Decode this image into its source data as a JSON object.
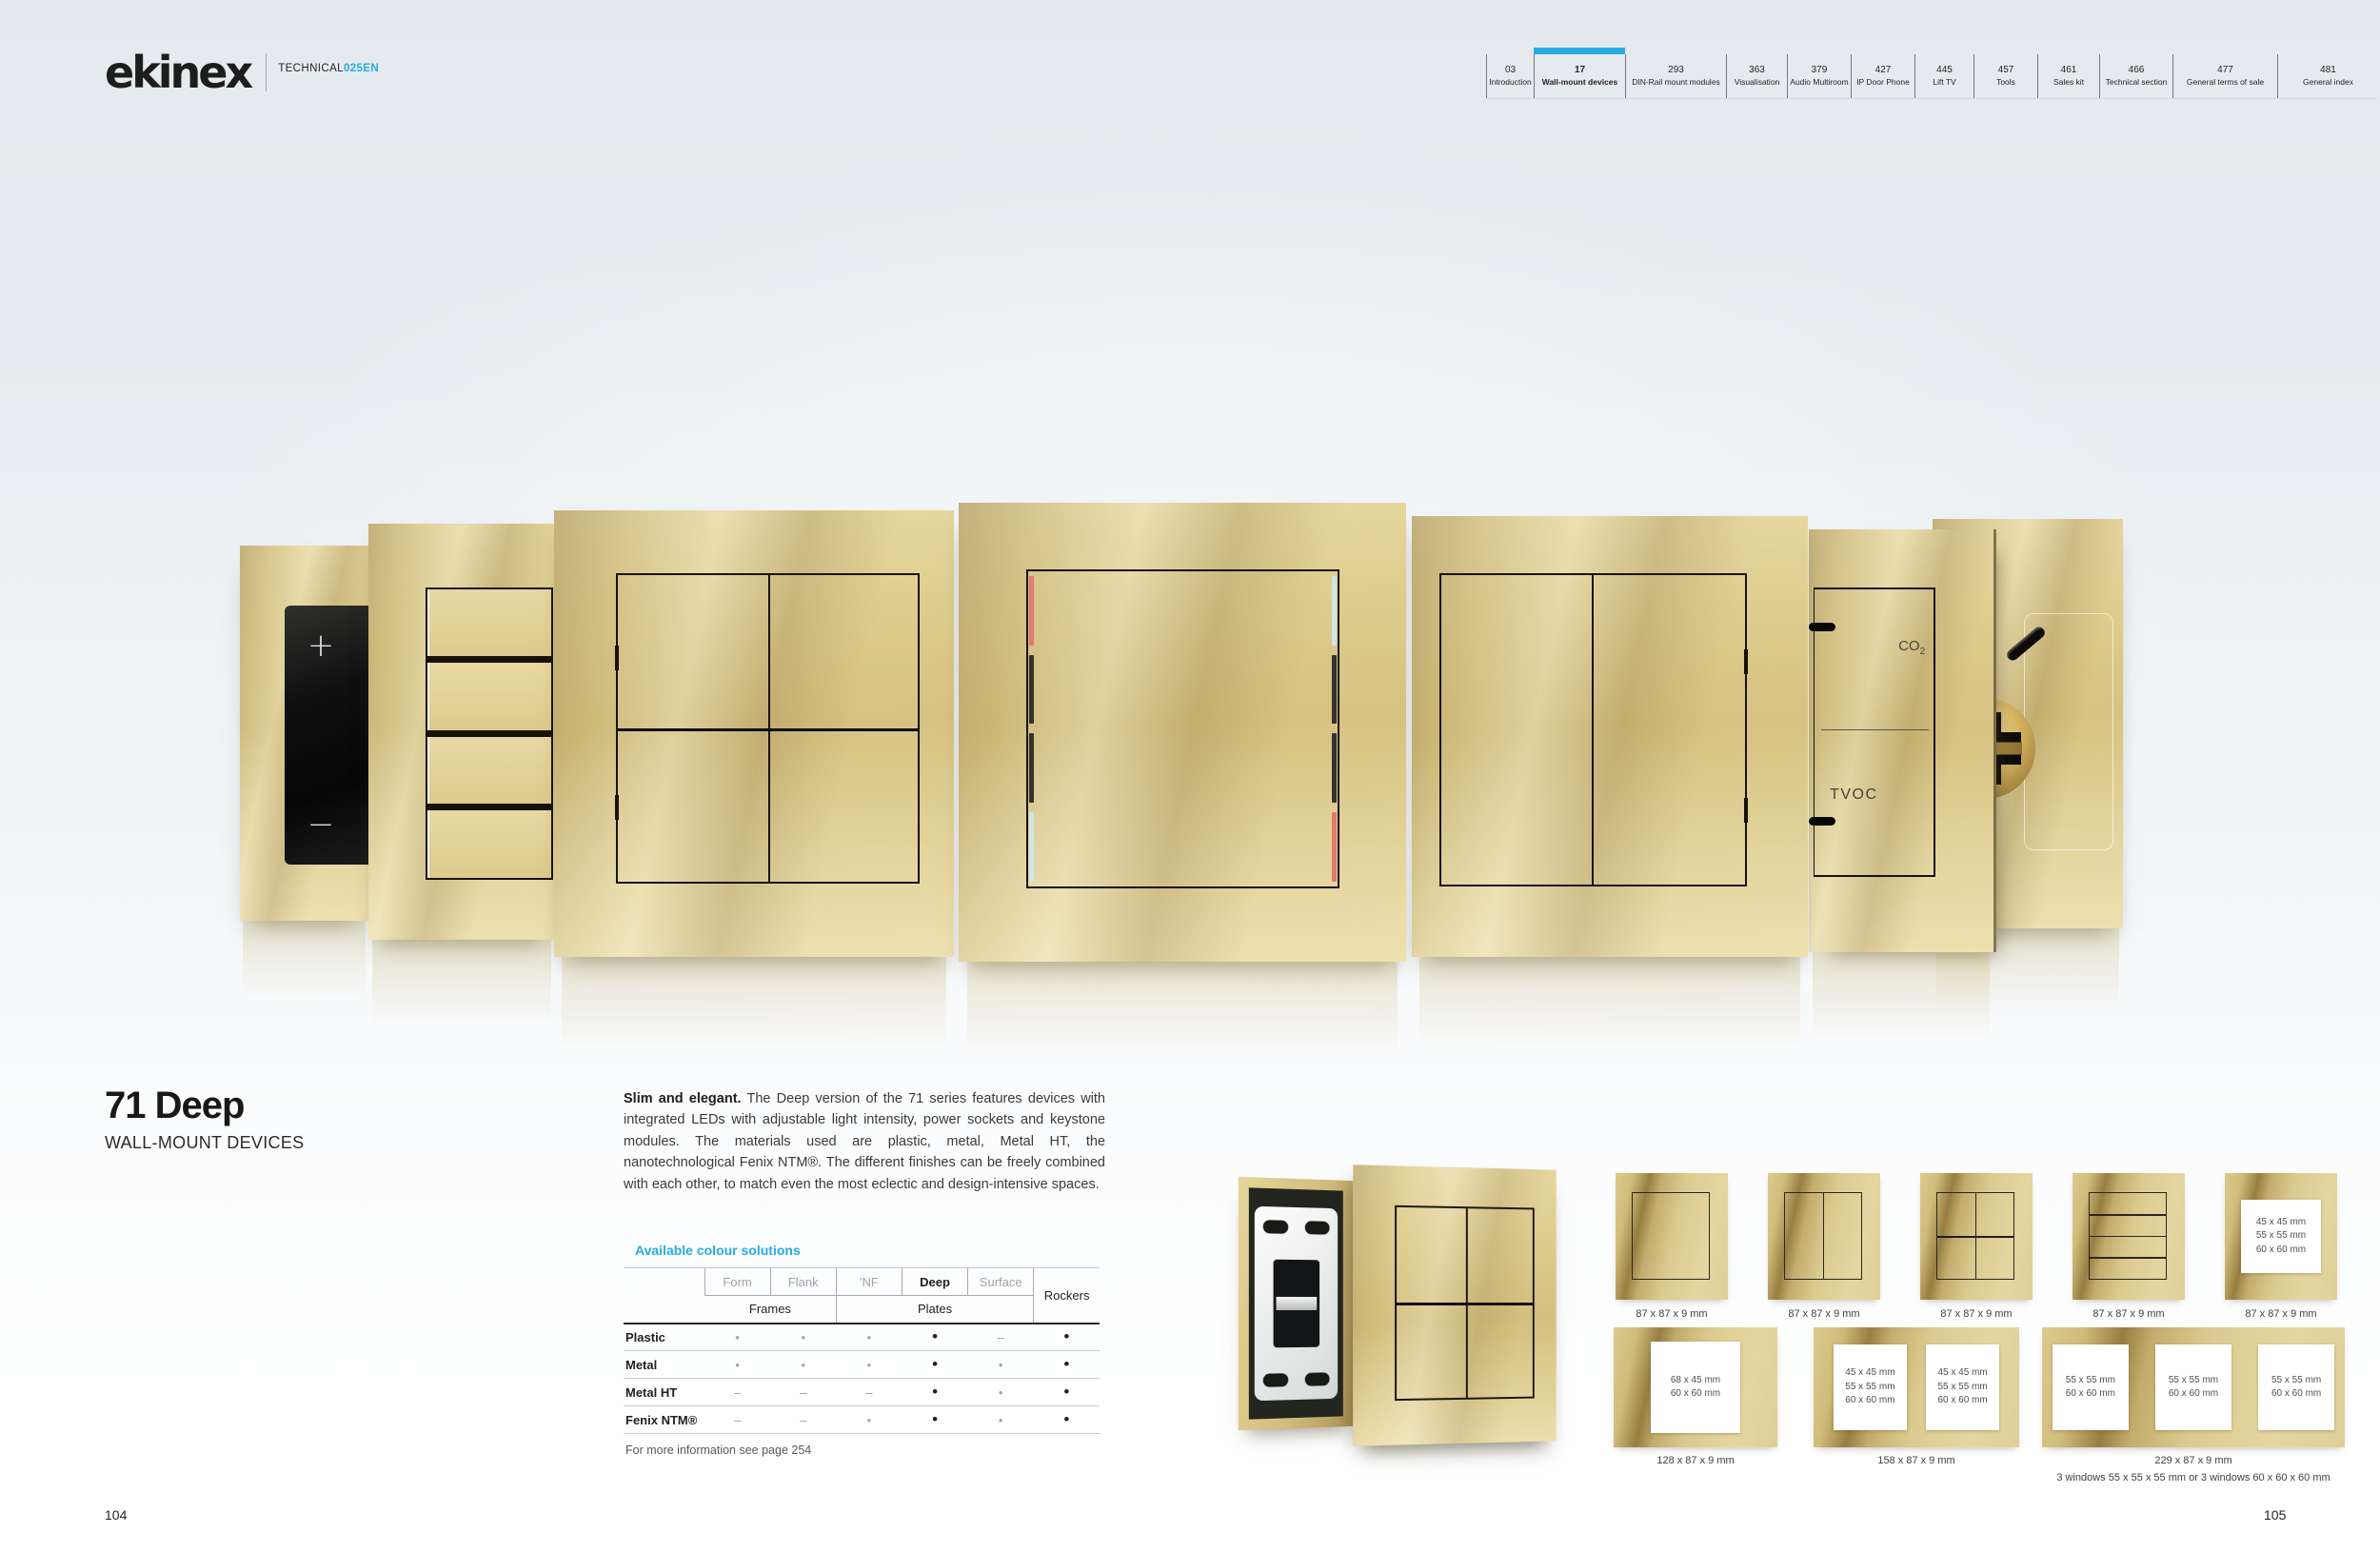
{
  "header": {
    "logo_text": "ekinex",
    "edition_prefix": "TECHNICAL",
    "edition_code": "025EN",
    "tabs": [
      {
        "page": "03",
        "label": "Introduction",
        "active": false
      },
      {
        "page": "17",
        "label": "Wall-mount devices",
        "active": true
      },
      {
        "page": "293",
        "label": "DIN-Rail mount modules",
        "active": false
      },
      {
        "page": "363",
        "label": "Visualisation",
        "active": false
      },
      {
        "page": "379",
        "label": "Audio Multiroom",
        "active": false
      },
      {
        "page": "427",
        "label": "IP Door Phone",
        "active": false
      },
      {
        "page": "445",
        "label": "Lift TV",
        "active": false
      },
      {
        "page": "457",
        "label": "Tools",
        "active": false
      },
      {
        "page": "461",
        "label": "Sales kit",
        "active": false
      },
      {
        "page": "466",
        "label": "Technical section",
        "active": false
      },
      {
        "page": "477",
        "label": "General terms of sale",
        "active": false
      },
      {
        "page": "481",
        "label": "General index",
        "active": false
      }
    ]
  },
  "hero": {
    "dimmer_plus": "+",
    "dimmer_minus": "−",
    "co2_base": "CO",
    "co2_sub": "2",
    "tvoc_label": "TVOC"
  },
  "product": {
    "title": "71 Deep",
    "subtitle": "WALL-MOUNT DEVICES",
    "description_lead": "Slim and elegant.",
    "description_body": " The Deep version of the 71 series features devices with integrated LEDs with adjustable light intensity, power sockets and keystone modules. The materials used are plastic, metal, Metal HT, the nanotechnological Fenix NTM®. The different finishes can be freely combined with each other, to match even the most eclectic and design-intensive spaces."
  },
  "colour_table": {
    "heading": "Available colour solutions",
    "series_columns": [
      "Form",
      "Flank",
      "'NF",
      "Deep",
      "Surface"
    ],
    "group_frames": "Frames",
    "group_plates": "Plates",
    "group_rockers": "Rockers",
    "rows": [
      {
        "material": "Plastic",
        "cells": [
          {
            "glyph": "•",
            "tone": "gray"
          },
          {
            "glyph": "•",
            "tone": "gray"
          },
          {
            "glyph": "•",
            "tone": "gray"
          },
          {
            "glyph": "•",
            "tone": "black"
          },
          {
            "glyph": "–",
            "tone": "dash"
          },
          {
            "glyph": "•",
            "tone": "black"
          }
        ]
      },
      {
        "material": "Metal",
        "cells": [
          {
            "glyph": "•",
            "tone": "gray"
          },
          {
            "glyph": "•",
            "tone": "gray"
          },
          {
            "glyph": "•",
            "tone": "gray"
          },
          {
            "glyph": "•",
            "tone": "black"
          },
          {
            "glyph": "•",
            "tone": "gray"
          },
          {
            "glyph": "•",
            "tone": "black"
          }
        ]
      },
      {
        "material": "Metal HT",
        "cells": [
          {
            "glyph": "–",
            "tone": "dash"
          },
          {
            "glyph": "–",
            "tone": "dash"
          },
          {
            "glyph": "–",
            "tone": "dash"
          },
          {
            "glyph": "•",
            "tone": "black"
          },
          {
            "glyph": "•",
            "tone": "gray"
          },
          {
            "glyph": "•",
            "tone": "black"
          }
        ]
      },
      {
        "material": "Fenix NTM®",
        "cells": [
          {
            "glyph": "–",
            "tone": "dash"
          },
          {
            "glyph": "–",
            "tone": "dash"
          },
          {
            "glyph": "•",
            "tone": "gray"
          },
          {
            "glyph": "•",
            "tone": "black"
          },
          {
            "glyph": "•",
            "tone": "gray"
          },
          {
            "glyph": "•",
            "tone": "black"
          }
        ]
      }
    ],
    "footnote": "For more information see page 254"
  },
  "dimensions": {
    "row1": [
      {
        "caption": "87 x 87 x 9 mm"
      },
      {
        "caption": "87 x 87 x 9 mm"
      },
      {
        "caption": "87 x 87 x 9 mm"
      },
      {
        "caption": "87 x 87 x 9 mm"
      },
      {
        "caption": "87 x 87 x 9 mm",
        "window_lines": [
          "45 x 45 mm",
          "55 x 55 mm",
          "60 x 60 mm"
        ]
      }
    ],
    "row2": [
      {
        "caption": "128 x 87 x 9 mm",
        "windows": [
          [
            "68 x 45 mm",
            "60 x 60 mm"
          ]
        ]
      },
      {
        "caption": "158 x 87 x 9 mm",
        "windows": [
          [
            "45 x 45 mm",
            "55 x 55 mm",
            "60 x 60 mm"
          ],
          [
            "45 x 45 mm",
            "55 x 55 mm",
            "60 x 60 mm"
          ]
        ]
      },
      {
        "caption": "229 x 87 x 9 mm",
        "caption_line2": "3 windows 55 x 55 x 55 mm or 3 windows 60 x 60 x 60 mm",
        "windows": [
          [
            "55 x 55 mm",
            "60 x 60 mm"
          ],
          [
            "55 x 55 mm",
            "60 x 60 mm"
          ],
          [
            "55 x 55 mm",
            "60 x 60 mm"
          ]
        ]
      }
    ]
  },
  "footer": {
    "page_left": "104",
    "page_right": "105"
  },
  "colors": {
    "accent": "#29abe2",
    "gold_light": "#e7d7a0",
    "gold_dark": "#977d42",
    "text_dark": "#231f20",
    "text_gray": "#a0a2a5"
  }
}
